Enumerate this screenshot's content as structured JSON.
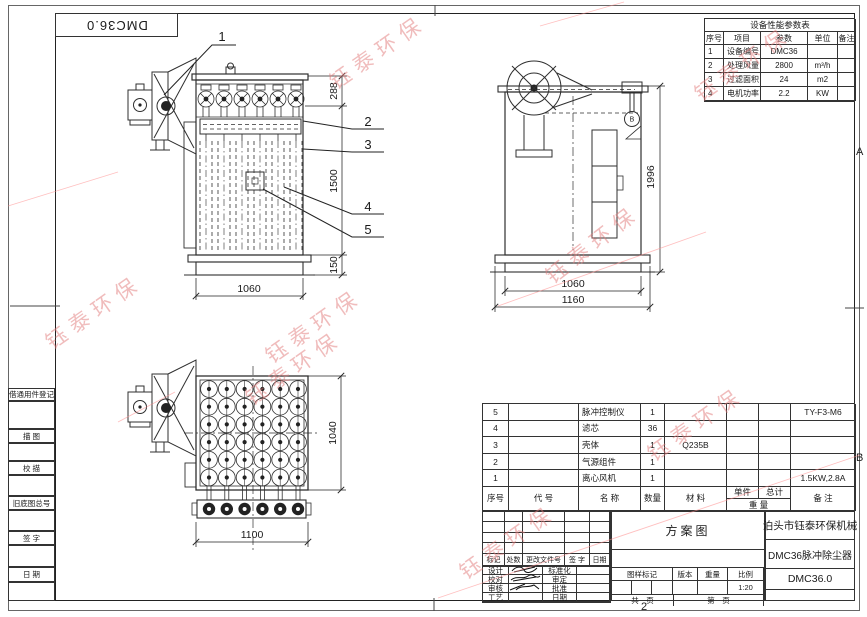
{
  "sheet": {
    "corner_ref": "DMC36.0",
    "zone_a": "A",
    "zone_b": "B",
    "zone_bottom": "2"
  },
  "margin_labels": [
    "借通用件登记",
    "描 图",
    "校 描",
    "旧底图总号",
    "签 字",
    "日 期"
  ],
  "params_table": {
    "title": "设备性能参数表",
    "headers": [
      "序号",
      "项目",
      "参数",
      "单位",
      "备注"
    ],
    "rows": [
      [
        "1",
        "设备编号",
        "DMC36",
        "",
        ""
      ],
      [
        "2",
        "处理风量",
        "2800",
        "m³/h",
        ""
      ],
      [
        "3",
        "过滤面积",
        "24",
        "m2",
        ""
      ],
      [
        "4",
        "电机功率",
        "2.2",
        "KW",
        ""
      ]
    ]
  },
  "bom": {
    "headers": {
      "no": "序号",
      "code": "代  号",
      "name": "名  称",
      "qty": "数量",
      "material": "材  料",
      "unit": "单件",
      "total": "总计",
      "weight": "重 量",
      "notes": "备  注"
    },
    "rows": [
      {
        "no": "5",
        "code": "",
        "name": "脉冲控制仪",
        "qty": "1",
        "material": "",
        "unit": "",
        "total": "",
        "notes": "TY-F3-M6"
      },
      {
        "no": "4",
        "code": "",
        "name": "滤芯",
        "qty": "36",
        "material": "",
        "unit": "",
        "total": "",
        "notes": ""
      },
      {
        "no": "3",
        "code": "",
        "name": "壳体",
        "qty": "1",
        "material": "Q235B",
        "unit": "",
        "total": "",
        "notes": ""
      },
      {
        "no": "2",
        "code": "",
        "name": "气源组件",
        "qty": "1",
        "material": "",
        "unit": "",
        "total": "",
        "notes": ""
      },
      {
        "no": "1",
        "code": "",
        "name": "离心风机",
        "qty": "1",
        "material": "",
        "unit": "",
        "total": "",
        "notes": "1.5KW,2.8A"
      }
    ]
  },
  "title_block": {
    "doc_type": "方案图",
    "company": "泊头市钰泰环保机械",
    "product": "DMC36脉冲除尘器",
    "drawing_no": "DMC36.0",
    "revision_headers": [
      "标记",
      "处数",
      "更改文件号",
      "签 字",
      "日期"
    ],
    "sign_labels": [
      [
        "设计",
        "标准化"
      ],
      [
        "校对",
        "审定"
      ],
      [
        "审核",
        "批准"
      ],
      [
        "工艺",
        "日期"
      ]
    ],
    "stamp_headers": [
      "图样标记",
      "版本",
      "重量",
      "比例"
    ],
    "scale": "1:20",
    "pages_total": "共　页",
    "pages_no": "第　页"
  },
  "views": {
    "front": {
      "dim_top": "288",
      "dim_body": "1500",
      "dim_base": "150",
      "dim_width": "1060",
      "balloons": [
        "1",
        "2",
        "3",
        "4",
        "5"
      ]
    },
    "side": {
      "dim_height": "1996",
      "dim_width_inner": "1060",
      "dim_width_outer": "1160",
      "gauge": "B"
    },
    "top": {
      "dim_depth": "1040",
      "dim_width": "1100"
    }
  },
  "watermark": {
    "text": "钰泰环保",
    "color": "#e27b7b"
  }
}
